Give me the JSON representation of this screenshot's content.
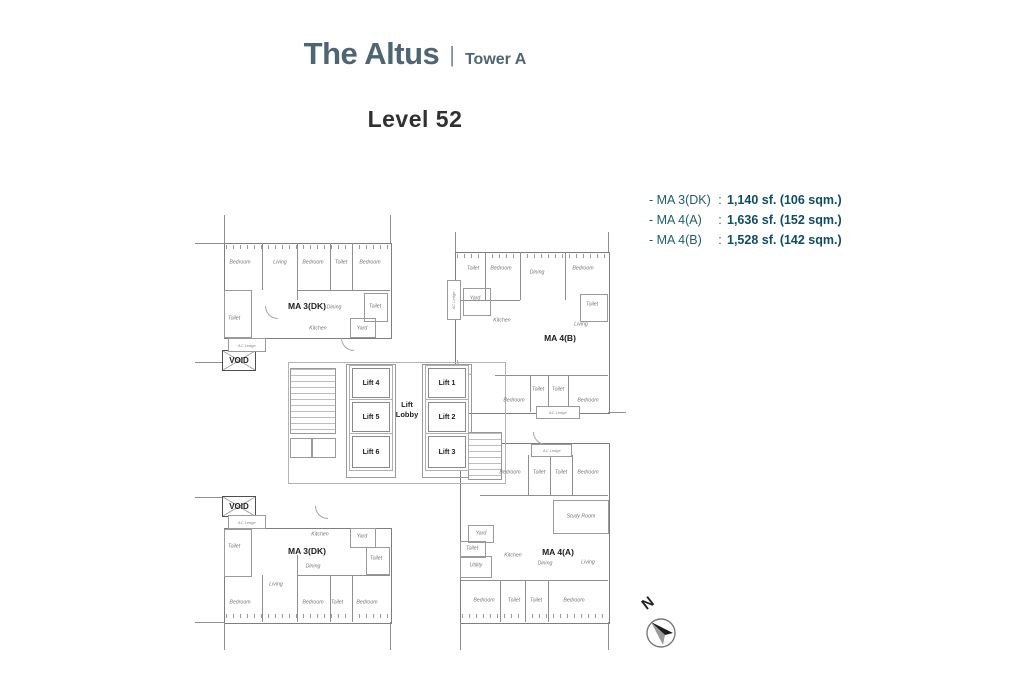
{
  "header": {
    "title": "The Altus",
    "separator": "|",
    "tower": "Tower A",
    "level": "Level 52"
  },
  "legend": [
    {
      "name": "- MA 3(DK)",
      "colon": ":",
      "value": "1,140 sf. (106 sqm.)"
    },
    {
      "name": "- MA 4(A)",
      "colon": ":",
      "value": "1,636 sf. (152 sqm.)"
    },
    {
      "name": "- MA 4(B)",
      "colon": ":",
      "value": "1,528 sf. (142 sqm.)"
    }
  ],
  "colors": {
    "title_accent": "#4e6673",
    "legend_text": "#1e5d72",
    "legend_value": "#0d4d66",
    "wall_line": "#8f8f8f"
  },
  "compass": {
    "label": "N"
  },
  "plan": {
    "units": [
      {
        "name": "MA 3(DK)",
        "nx": 112,
        "ny": 96,
        "rooms": [
          {
            "t": "Bedroom",
            "x": 45,
            "y": 52
          },
          {
            "t": "Living",
            "x": 85,
            "y": 52
          },
          {
            "t": "Bedroom",
            "x": 118,
            "y": 52
          },
          {
            "t": "Toilet",
            "x": 146,
            "y": 52
          },
          {
            "t": "Bedroom",
            "x": 175,
            "y": 52
          },
          {
            "t": "Toilet",
            "x": 39,
            "y": 108
          },
          {
            "t": "Dining",
            "x": 139,
            "y": 97
          },
          {
            "t": "Kitchen",
            "x": 123,
            "y": 118
          },
          {
            "t": "Yard",
            "x": 167,
            "y": 118
          },
          {
            "t": "Toilet",
            "x": 180,
            "y": 96
          }
        ]
      },
      {
        "name": "MA 4(B)",
        "nx": 365,
        "ny": 128,
        "rooms": [
          {
            "t": "Toilet",
            "x": 278,
            "y": 58
          },
          {
            "t": "Bedroom",
            "x": 306,
            "y": 58
          },
          {
            "t": "Dining",
            "x": 342,
            "y": 62
          },
          {
            "t": "Bedroom",
            "x": 388,
            "y": 58
          },
          {
            "t": "Yard",
            "x": 280,
            "y": 88
          },
          {
            "t": "Kitchen",
            "x": 307,
            "y": 110
          },
          {
            "t": "Toilet",
            "x": 397,
            "y": 94
          },
          {
            "t": "Living",
            "x": 386,
            "y": 114
          },
          {
            "t": "Bedroom",
            "x": 319,
            "y": 190
          },
          {
            "t": "Toilet",
            "x": 343,
            "y": 179
          },
          {
            "t": "Toilet",
            "x": 363,
            "y": 179
          },
          {
            "t": "Bedroom",
            "x": 393,
            "y": 190
          }
        ]
      },
      {
        "name": "MA 4(A)",
        "nx": 363,
        "ny": 342,
        "rooms": [
          {
            "t": "Bedroom",
            "x": 315,
            "y": 262
          },
          {
            "t": "Toilet",
            "x": 344,
            "y": 262
          },
          {
            "t": "Toilet",
            "x": 366,
            "y": 262
          },
          {
            "t": "Bedroom",
            "x": 393,
            "y": 262
          },
          {
            "t": "Study Room",
            "x": 386,
            "y": 306
          },
          {
            "t": "Yard",
            "x": 286,
            "y": 323
          },
          {
            "t": "Toilet",
            "x": 277,
            "y": 338
          },
          {
            "t": "Utility",
            "x": 281,
            "y": 355
          },
          {
            "t": "Kitchen",
            "x": 318,
            "y": 345
          },
          {
            "t": "Dining",
            "x": 350,
            "y": 353
          },
          {
            "t": "Living",
            "x": 393,
            "y": 352
          },
          {
            "t": "Bedroom",
            "x": 289,
            "y": 390
          },
          {
            "t": "Toilet",
            "x": 319,
            "y": 390
          },
          {
            "t": "Toilet",
            "x": 341,
            "y": 390
          },
          {
            "t": "Bedroom",
            "x": 379,
            "y": 390
          }
        ]
      },
      {
        "name": "MA 3(DK)",
        "nx": 112,
        "ny": 341,
        "rooms": [
          {
            "t": "Toilet",
            "x": 39,
            "y": 336
          },
          {
            "t": "Kitchen",
            "x": 125,
            "y": 324
          },
          {
            "t": "Yard",
            "x": 167,
            "y": 326
          },
          {
            "t": "Toilet",
            "x": 181,
            "y": 348
          },
          {
            "t": "Dining",
            "x": 118,
            "y": 356
          },
          {
            "t": "Living",
            "x": 81,
            "y": 374
          },
          {
            "t": "Bedroom",
            "x": 45,
            "y": 392
          },
          {
            "t": "Bedroom",
            "x": 118,
            "y": 392
          },
          {
            "t": "Toilet",
            "x": 142,
            "y": 392
          },
          {
            "t": "Bedroom",
            "x": 172,
            "y": 392
          }
        ]
      }
    ],
    "lifts": [
      {
        "label": "Lift 4",
        "x": 157,
        "y": 158,
        "w": 36,
        "h": 28
      },
      {
        "label": "Lift 5",
        "x": 157,
        "y": 192,
        "w": 36,
        "h": 28
      },
      {
        "label": "Lift 6",
        "x": 157,
        "y": 226,
        "w": 36,
        "h": 30
      },
      {
        "label": "Lift 1",
        "x": 233,
        "y": 158,
        "w": 36,
        "h": 28
      },
      {
        "label": "Lift 2",
        "x": 233,
        "y": 192,
        "w": 36,
        "h": 28
      },
      {
        "label": "Lift 3",
        "x": 233,
        "y": 226,
        "w": 36,
        "h": 30
      }
    ],
    "lobby": {
      "label": "Lift Lobby",
      "x": 212,
      "y": 200
    },
    "voids": [
      {
        "label": "VOID",
        "x": 27,
        "y": 140,
        "w": 32,
        "h": 19
      },
      {
        "label": "VOID",
        "x": 27,
        "y": 286,
        "w": 32,
        "h": 19
      }
    ],
    "ledges": [
      {
        "label": "AC Ledge",
        "x": 33,
        "y": 128,
        "w": 36,
        "h": 12,
        "vertical": false
      },
      {
        "label": "AC Ledge",
        "x": 33,
        "y": 305,
        "w": 36,
        "h": 12,
        "vertical": false
      },
      {
        "label": "AC Ledge",
        "x": 341,
        "y": 196,
        "w": 42,
        "h": 11,
        "vertical": false
      },
      {
        "label": "AC Ledge",
        "x": 336,
        "y": 234,
        "w": 39,
        "h": 11,
        "vertical": false
      },
      {
        "label": "AC Ledge",
        "x": 252,
        "y": 70,
        "w": 12,
        "h": 38,
        "vertical": true
      }
    ]
  }
}
